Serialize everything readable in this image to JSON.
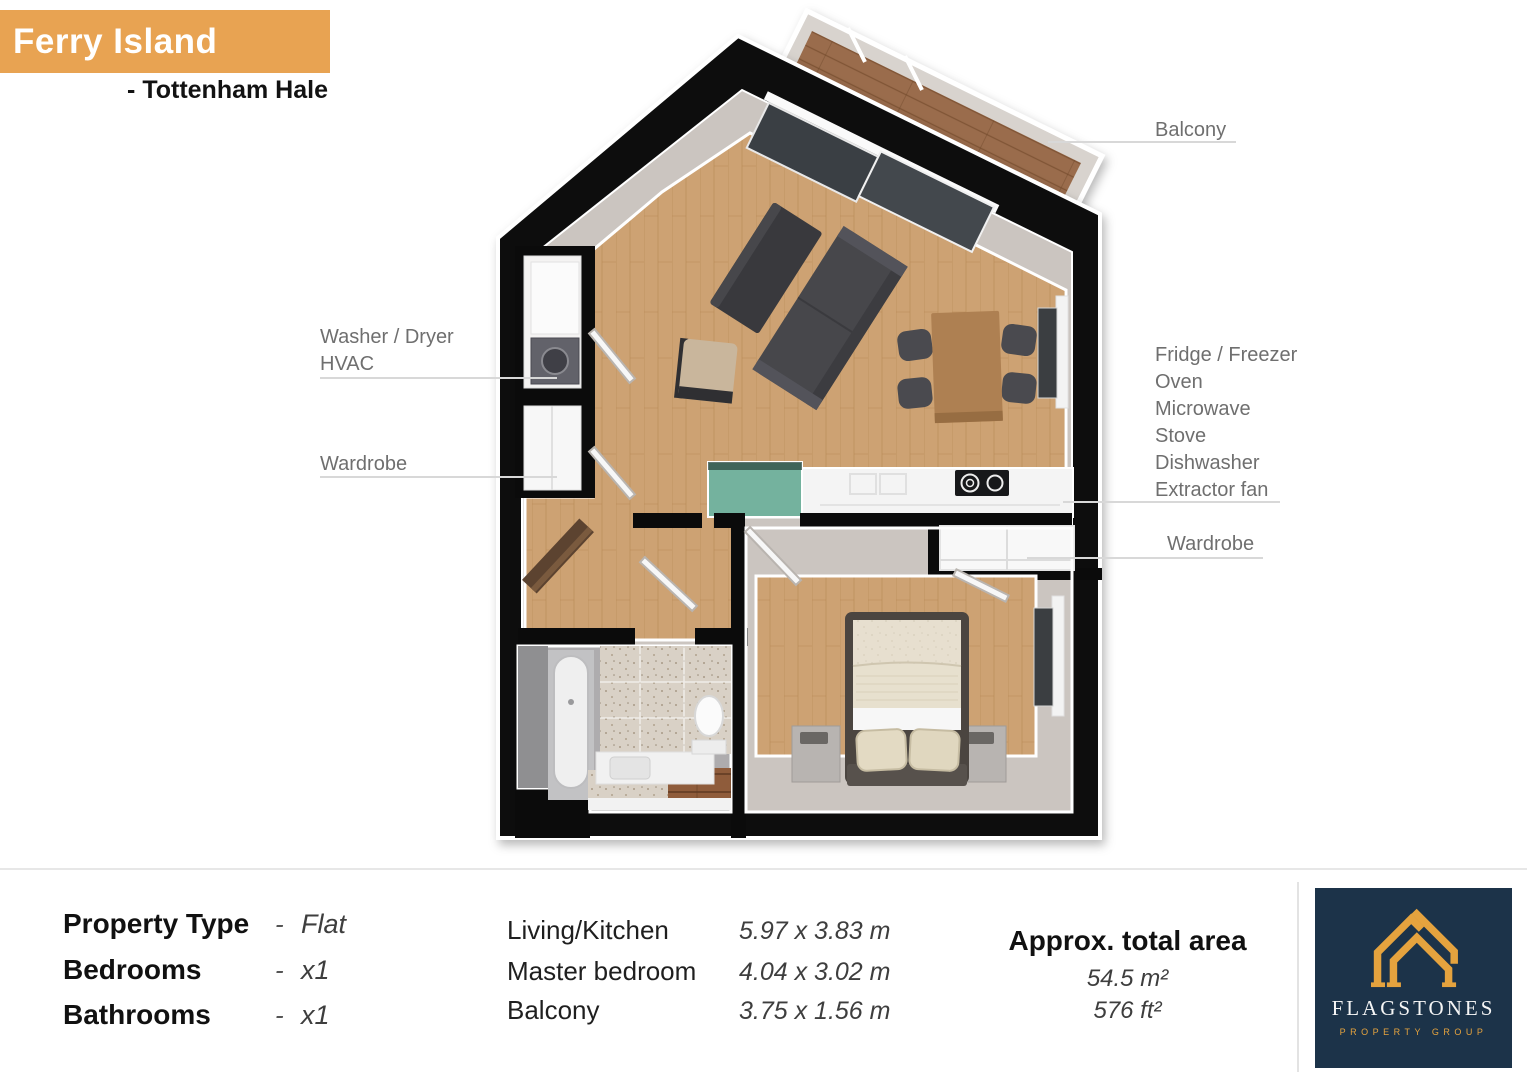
{
  "header": {
    "title": "Ferry Island",
    "subtitle": "- Tottenham Hale"
  },
  "plan_labels": {
    "balcony": "Balcony",
    "washer_dryer": "Washer / Dryer",
    "hvac": "HVAC",
    "wardrobe_left": "Wardrobe",
    "appliances": [
      "Fridge / Freezer",
      "Oven",
      "Microwave",
      "Stove",
      "Dishwasher",
      "Extractor fan"
    ],
    "wardrobe_right": "Wardrobe"
  },
  "property": {
    "rows": [
      {
        "label": "Property Type",
        "sep": "-",
        "value": "Flat"
      },
      {
        "label": "Bedrooms",
        "sep": "-",
        "value": "x1"
      },
      {
        "label": "Bathrooms",
        "sep": "-",
        "value": "x1"
      }
    ]
  },
  "dimensions": {
    "rows": [
      {
        "room": "Living/Kitchen",
        "size": "5.97 x 3.83 m"
      },
      {
        "room": "Master bedroom",
        "size": "4.04 x 3.02 m"
      },
      {
        "room": "Balcony",
        "size": "3.75 x 1.56 m"
      }
    ]
  },
  "total_area": {
    "title": "Approx. total area",
    "metric": "54.5 m²",
    "imperial": "576 ft²"
  },
  "logo": {
    "name": "FLAGSTONES",
    "tagline": "PROPERTY GROUP"
  },
  "colors": {
    "accent_orange": "#E8A352",
    "logo_navy": "#1C3349",
    "logo_gold": "#E5A33E",
    "label_gray": "#6F6F6F",
    "wall_black": "#0B0B0B"
  }
}
